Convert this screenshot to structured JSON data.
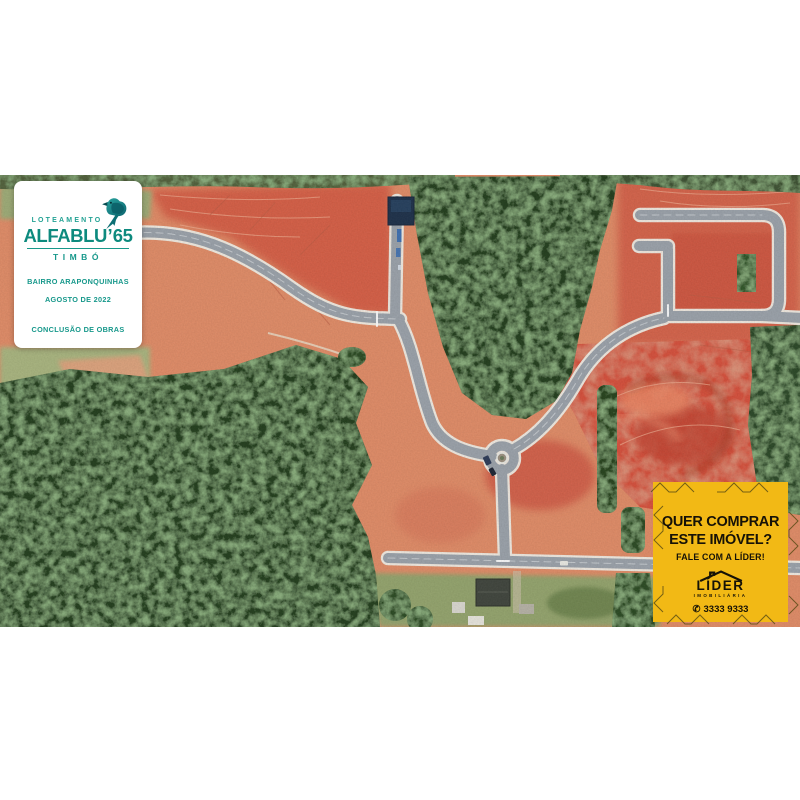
{
  "brand_panel": {
    "loteamento_label": "LOTEAMENTO",
    "name": "ALFABLU",
    "number": "65",
    "city": "TIMBÓ",
    "badges": [
      "BAIRRO ARAPONQUINHAS",
      "AGOSTO DE 2022",
      "CONCLUSÃO DE OBRAS"
    ],
    "accent_color": "#12948a",
    "icon": "bird-icon"
  },
  "watermark": {
    "name": "LÍDER",
    "subtitle": "IMOBILIÁRIA",
    "icon": "roof-icon"
  },
  "cta_box": {
    "line1": "QUER COMPRAR",
    "line2": "ESTE IMÓVEL?",
    "line3": "FALE COM A LÍDER!",
    "logo_name": "LÍDER",
    "logo_subtitle": "IMOBILIÁRIA",
    "phone": "3333 9333",
    "icons": [
      "roof-icon",
      "phone-icon"
    ],
    "background_color": "#f2b915",
    "text_color": "#161207"
  }
}
